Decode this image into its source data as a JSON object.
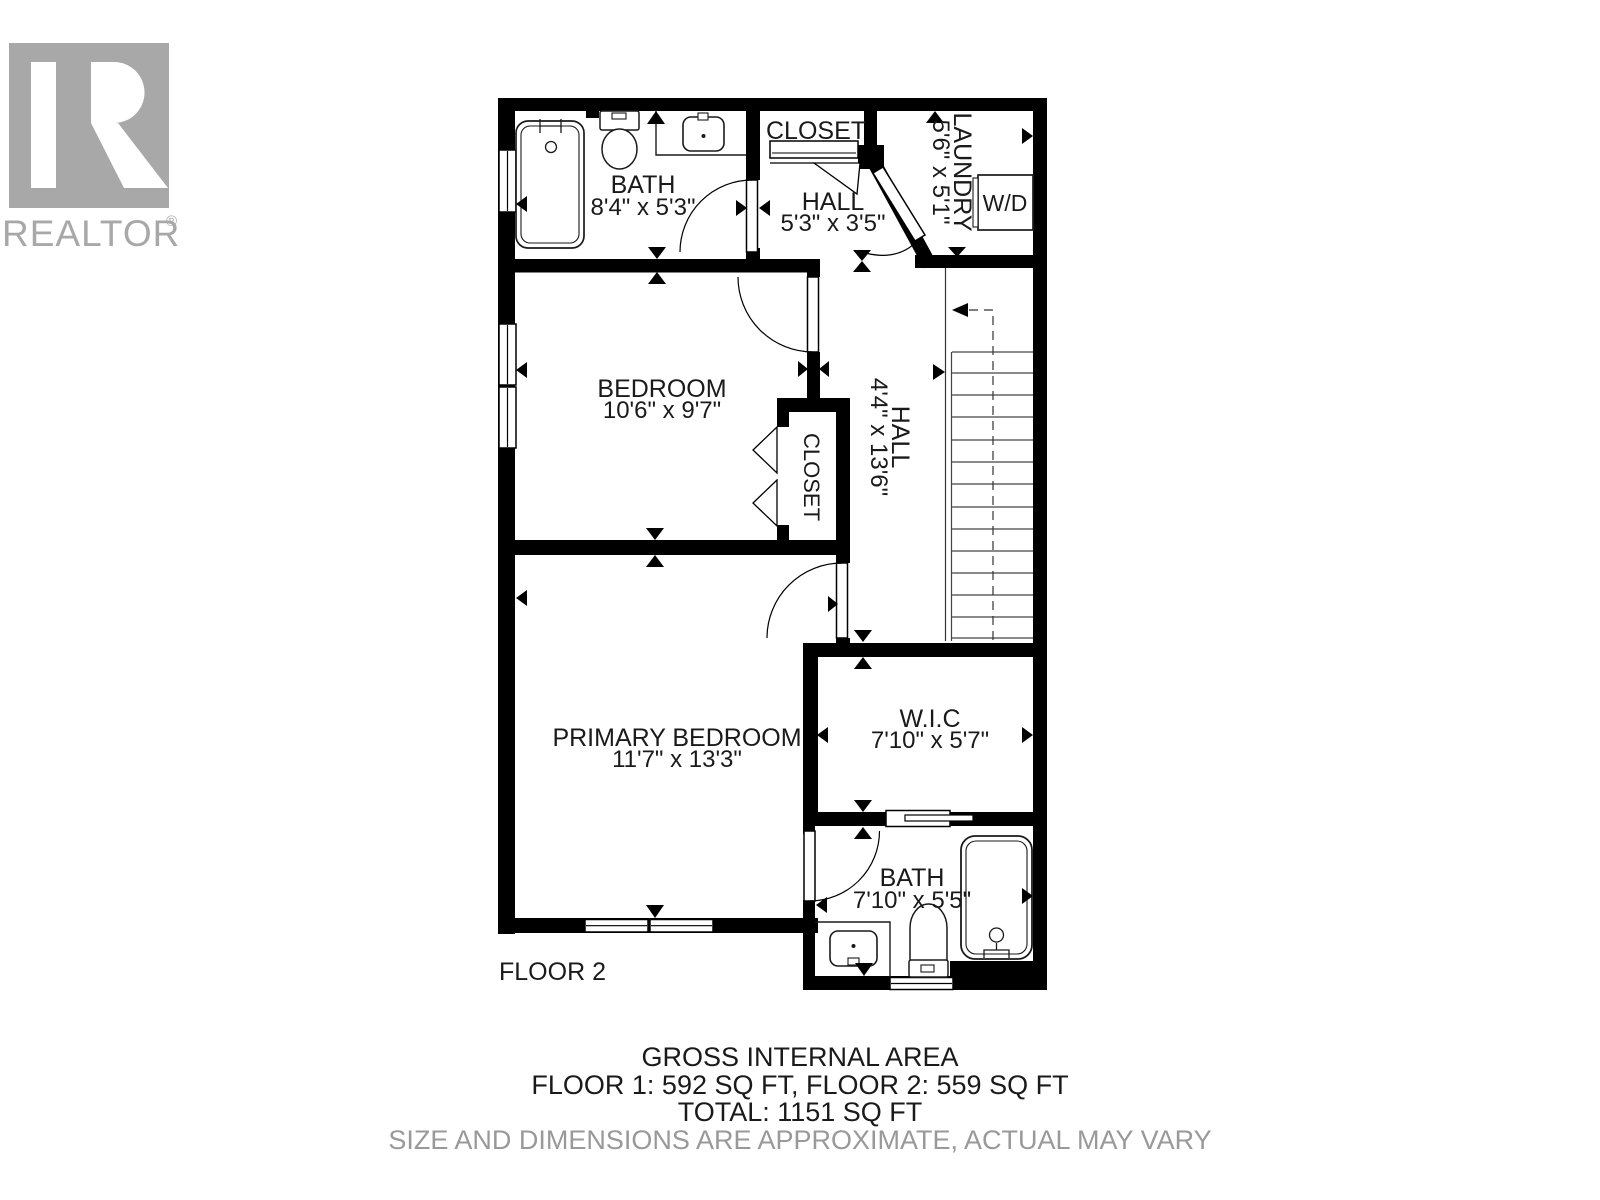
{
  "branding": {
    "name": "REALTOR",
    "reg": "®"
  },
  "rooms": {
    "bath1": {
      "name": "BATH",
      "dims": "8'4\" x 5'3\""
    },
    "closet_top": {
      "name": "CLOSET"
    },
    "hall_top": {
      "name": "HALL",
      "dims": "5'3\" x 3'5\""
    },
    "laundry": {
      "name": "LAUNDRY",
      "dims": "5'6\" x 5'1\""
    },
    "wd": {
      "name": "W/D"
    },
    "bedroom": {
      "name": "BEDROOM",
      "dims": "10'6\" x 9'7\""
    },
    "closet_mid": {
      "name": "CLOSET"
    },
    "hall_main": {
      "name": "HALL",
      "dims": "4'4\" x 13'6\""
    },
    "primary": {
      "name": "PRIMARY BEDROOM",
      "dims": "11'7\" x 13'3\""
    },
    "wic": {
      "name": "W.I.C",
      "dims": "7'10\" x 5'7\""
    },
    "bath2": {
      "name": "BATH",
      "dims": "7'10\" x 5'5\""
    }
  },
  "floor_label": "FLOOR 2",
  "footer": {
    "line1": "GROSS INTERNAL AREA",
    "line2": "FLOOR 1: 592 SQ FT, FLOOR 2: 559 SQ FT",
    "line3": "TOTAL: 1151 SQ FT",
    "disclaimer": "SIZE AND DIMENSIONS ARE APPROXIMATE, ACTUAL MAY VARY"
  },
  "colors": {
    "wall": "#000000",
    "logo_gray": "#a8a8a8",
    "disclaimer_gray": "#999999"
  }
}
